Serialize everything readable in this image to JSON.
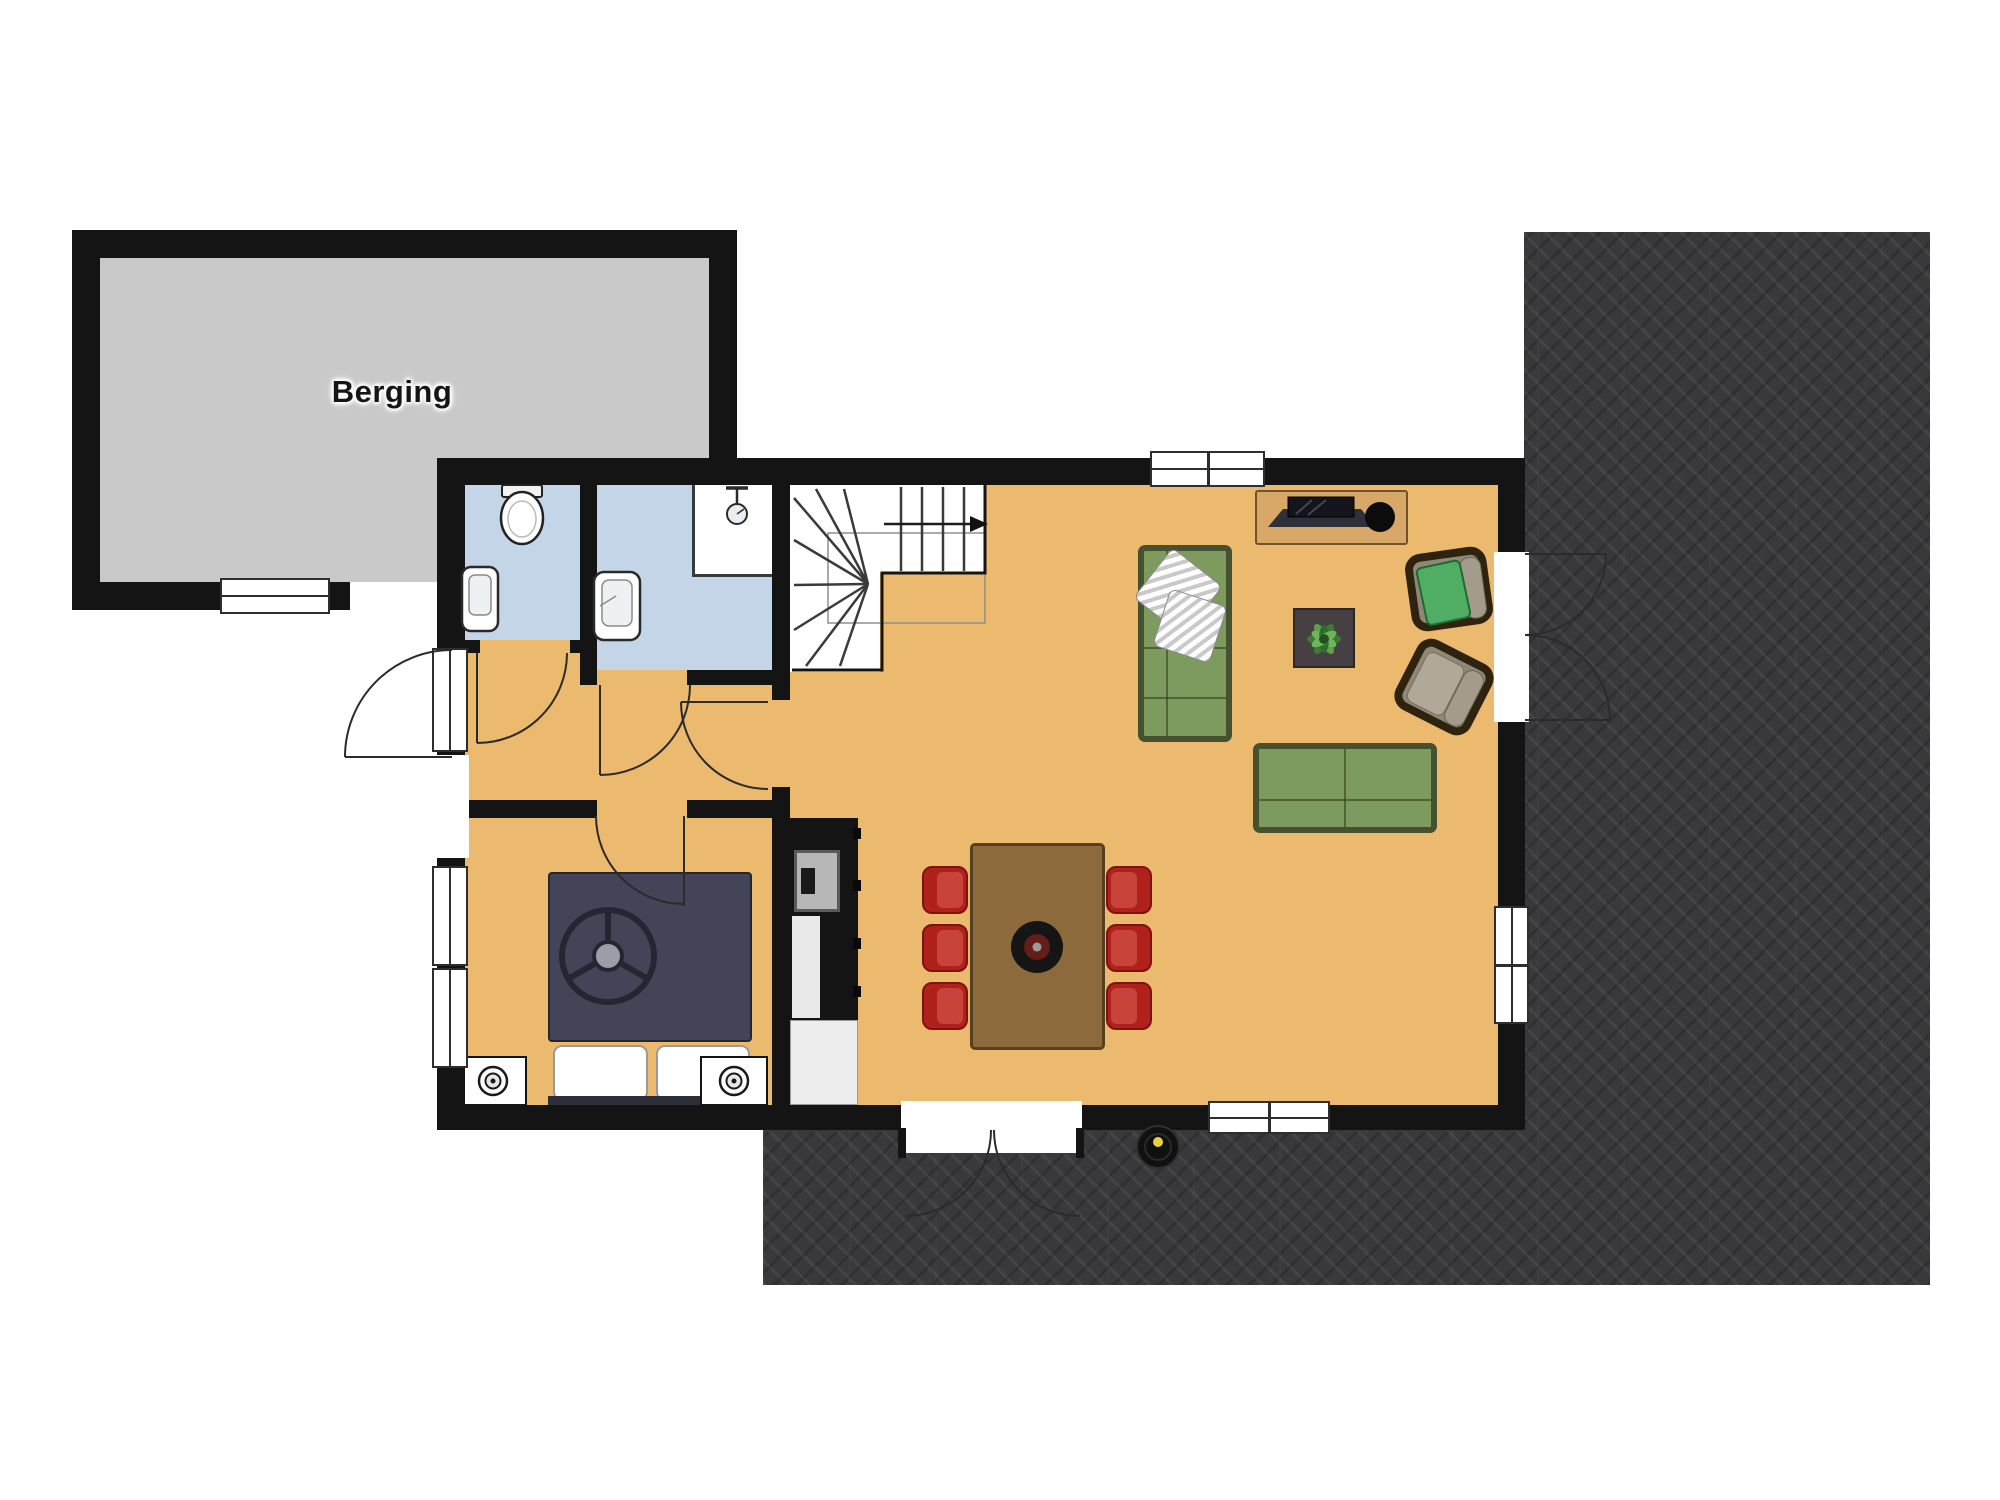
{
  "label": {
    "berging": "Berging"
  },
  "palette": {
    "wall": "#141414",
    "floor_wood": "#ecba6e",
    "floor_storage": "#c9c9c9",
    "floor_bathroom": "#c3d5e7",
    "terrace_dark": "#39393b",
    "sofa_green": "#7d9a5f",
    "armchair_cushion_green": "#4fae63",
    "dining_chair_red": "#b0211c",
    "table_wood": "#8d6a3b",
    "sideboard_wood": "#d8a868",
    "bed_duvet_navy": "#434457",
    "vacuum_accent_yellow": "#e7cf3e"
  },
  "fixtures": [
    "toilet-icon",
    "sink-icon",
    "shower-icon",
    "stairs-icon",
    "bed-icon",
    "nightstand-lamp-icon",
    "kitchen-oven-icon",
    "dining-table-icon",
    "dining-chair-icon",
    "sofa-icon",
    "armchair-icon",
    "tv-sideboard-icon",
    "plant-table-icon",
    "robot-vacuum-icon",
    "door-swing-icon",
    "window-icon"
  ]
}
